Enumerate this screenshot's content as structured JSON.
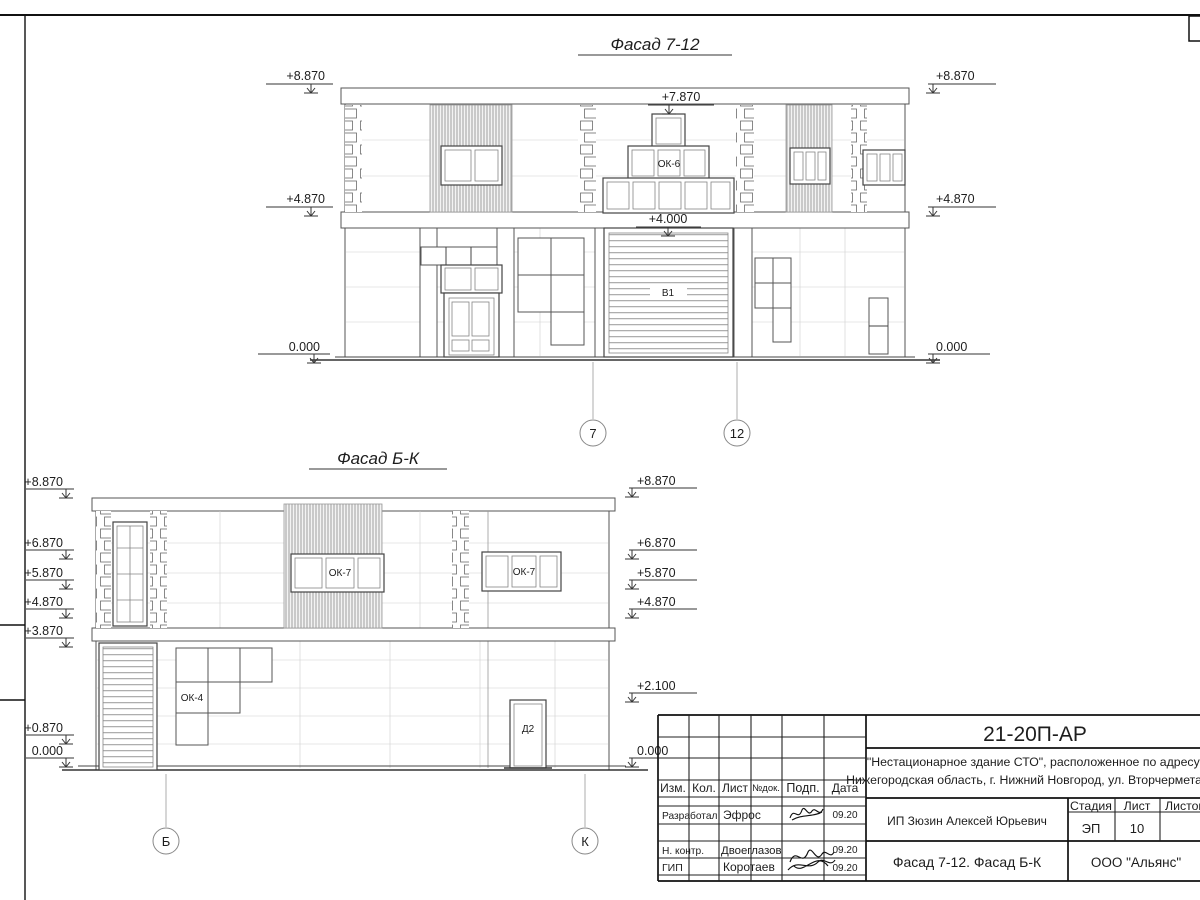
{
  "sheet": {
    "facade_7_12": {
      "title": "Фасад 7-12",
      "marks": {
        "left": [
          "+8.870",
          "+4.870",
          "0.000"
        ],
        "right": [
          "+8.870",
          "+4.870",
          "0.000"
        ],
        "ridge": "+7.870",
        "gate_top": "+4.000"
      },
      "labels": {
        "window_ok6": "ОК-6",
        "gate_v1": "В1"
      },
      "axes": [
        "7",
        "12"
      ]
    },
    "facade_b_k": {
      "title": "Фасад Б-К",
      "marks": {
        "left": [
          "+8.870",
          "+6.870",
          "+5.870",
          "+4.870",
          "+3.870",
          "+0.870",
          "0.000"
        ],
        "right": [
          "+8.870",
          "+6.870",
          "+5.870",
          "+4.870",
          "+2.100",
          "0.000"
        ]
      },
      "labels": {
        "window_ok7_left": "ОК-7",
        "window_ok7_right": "ОК-7",
        "window_ok4": "ОК-4",
        "door_d2": "Д2"
      },
      "axes": [
        "Б",
        "К"
      ]
    },
    "title_block": {
      "document_number": "21-20П-АР",
      "project_name_line1": "\"Нестационарное здание СТО\", расположенное по адресу:",
      "project_name_line2": "Нижегородская область, г. Нижний Новгород, ул. Вторчермета, 1А",
      "columns": [
        "Изм.",
        "Кол.",
        "Лист",
        "№док.",
        "Подп.",
        "Дата"
      ],
      "rows": [
        {
          "role": "Разработал",
          "name": "Эфрос",
          "date": "09.20"
        },
        {
          "role": "Н. контр.",
          "name": "Двоеглазов",
          "date": "09.20"
        },
        {
          "role": "ГИП",
          "name": "Коротаев",
          "date": "09.20"
        }
      ],
      "client": "ИП Зюзин Алексей Юрьевич",
      "stage_label": "Стадия",
      "sheet_label": "Лист",
      "sheets_label": "Листов",
      "stage": "ЭП",
      "sheet_number": "10",
      "sheet_title": "Фасад 7-12. Фасад Б-К",
      "organization": "ООО \"Альянс\""
    }
  }
}
